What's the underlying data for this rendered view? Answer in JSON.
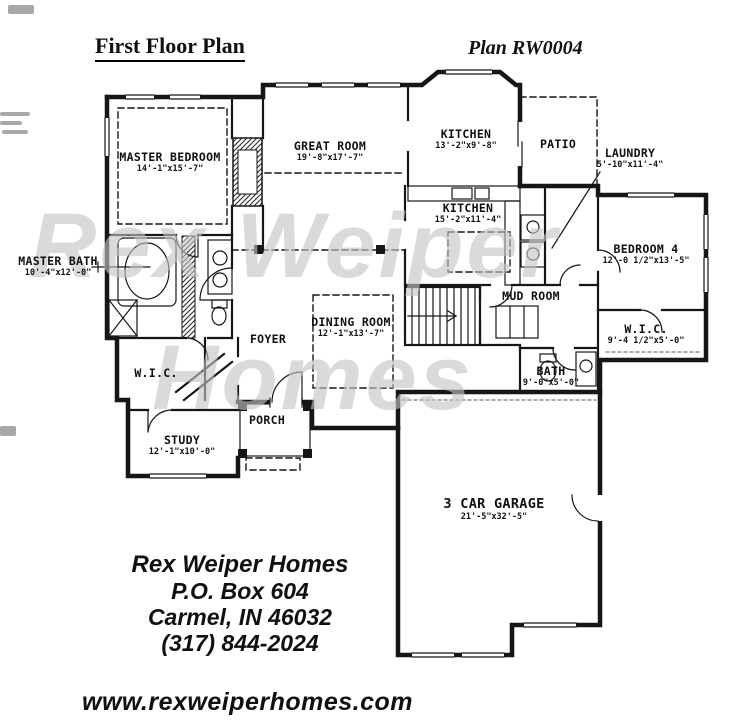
{
  "header": {
    "title": "First Floor Plan",
    "plan_number": "Plan RW0004"
  },
  "watermark": {
    "line1": "Rex Weiper",
    "line2": "Homes"
  },
  "rooms": [
    {
      "label": "MASTER BEDROOM",
      "dims": "14'-1\"x15'-7\""
    },
    {
      "label": "GREAT ROOM",
      "dims": "19'-8\"x17'-7\""
    },
    {
      "label": "KITCHEN",
      "dims": "13'-2\"x9'-8\""
    },
    {
      "label": "PATIO",
      "dims": ""
    },
    {
      "label": "LAUNDRY",
      "dims": "5'-10\"x11'-4\""
    },
    {
      "label": "KITCHEN",
      "dims": "15'-2\"x11'-4\""
    },
    {
      "label": "MASTER BATH",
      "dims": "10'-4\"x12'-0\""
    },
    {
      "label": "BEDROOM 4",
      "dims": "12'-0 1/2\"x13'-5\""
    },
    {
      "label": "MUD ROOM",
      "dims": ""
    },
    {
      "label": "W.I.C.",
      "dims": "9'-4 1/2\"x5'-0\""
    },
    {
      "label": "DINING ROOM",
      "dims": "12'-1\"x13'-7\""
    },
    {
      "label": "FOYER",
      "dims": ""
    },
    {
      "label": "BATH",
      "dims": "9'-0\"x5'-0\""
    },
    {
      "label": "W.I.C.",
      "dims": ""
    },
    {
      "label": "PORCH",
      "dims": ""
    },
    {
      "label": "STUDY",
      "dims": "12'-1\"x10'-0\""
    },
    {
      "label": "3 CAR GARAGE",
      "dims": "21'-5\"x32'-5\""
    }
  ],
  "footer": {
    "company": "Rex Weiper Homes",
    "address_line1": "P.O. Box 604",
    "address_line2": "Carmel, IN  46032",
    "phone": "(317) 844-2024"
  },
  "website": "www.rexweiperhomes.com",
  "colors": {
    "ink": "#161616",
    "watermark": "#c4c4c4",
    "paper": "#ffffff"
  }
}
